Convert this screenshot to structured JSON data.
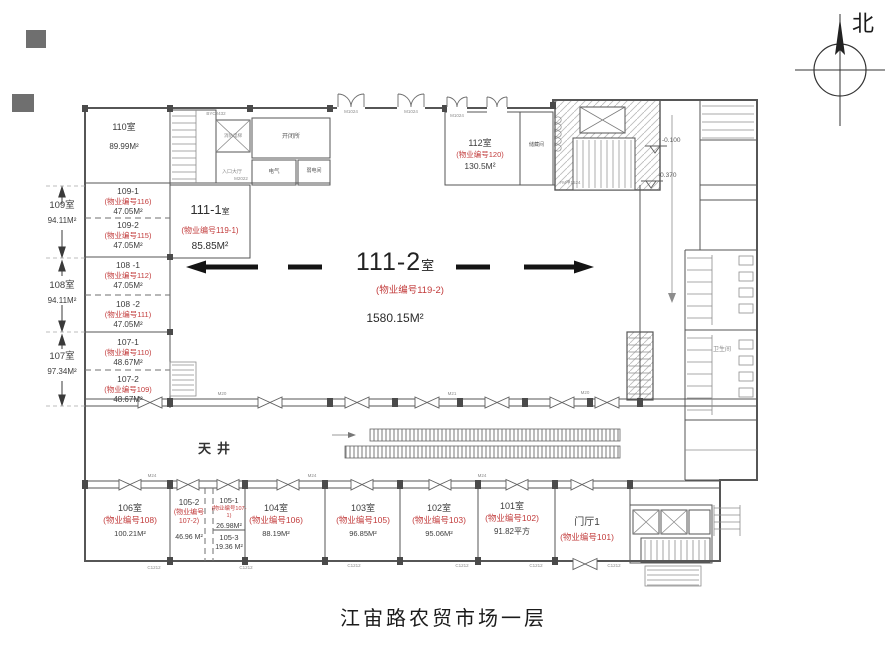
{
  "title": {
    "caption": "江宙路农贸市场一层"
  },
  "compass": {
    "north_label": "北"
  },
  "hall": {
    "num": "111-2",
    "suffix": "室",
    "code": "(物业编号119-2)",
    "area": "1580.15M²"
  },
  "rooms": {
    "r110": {
      "name": "110室",
      "area": "89.99M²"
    },
    "r111_1": {
      "num": "111-1",
      "suffix": "室",
      "code": "(物业编号119-1)",
      "area": "85.85M²"
    },
    "r112": {
      "name": "112室",
      "code": "(物业编号120)",
      "area": "130.5M²"
    },
    "r109_1": {
      "name": "109-1",
      "code": "(物业编号116)",
      "area": "47.05M²"
    },
    "r109_2": {
      "name": "109-2",
      "code": "(物业编号115)",
      "area": "47.05M²"
    },
    "r108_1": {
      "name": "108 -1",
      "code": "(物业编号112)",
      "area": "47.05M²"
    },
    "r108_2": {
      "name": "108 -2",
      "code": "(物业编号111)",
      "area": "47.05M²"
    },
    "r107_1": {
      "name": "107-1",
      "code": "(物业编号110)",
      "area": "48.67M²"
    },
    "r107_2": {
      "name": "107-2",
      "code": "(物业编号109)",
      "area": "48.67M²"
    },
    "r106": {
      "name": "106室",
      "code": "(物业编号108)",
      "area": "100.21M²"
    },
    "r105_2": {
      "name": "105-2",
      "code": "(物业编号107-2)",
      "area": "46.96 M²"
    },
    "r105_1": {
      "name": "105-1",
      "code": "(物业编号107-1)",
      "area": "26.98M²"
    },
    "r105_3": {
      "name": "105-3",
      "area": "19.36 M²"
    },
    "r104": {
      "name": "104室",
      "code": "(物业编号106)",
      "area": "88.19M²"
    },
    "r103": {
      "name": "103室",
      "code": "(物业编号105)",
      "area": "96.85M²"
    },
    "r102": {
      "name": "102室",
      "code": "(物业编号103)",
      "area": "95.06M²"
    },
    "r101": {
      "name": "101室",
      "code": "(物业编号102)",
      "area": "91.82平方"
    },
    "lobby": {
      "name": "门厅1",
      "code": "(物业编号101)"
    }
  },
  "dims": {
    "d109": {
      "name": "109室",
      "area": "94.11M²"
    },
    "d108": {
      "name": "108室",
      "area": "94.11M²"
    },
    "d107": {
      "name": "107室",
      "area": "97.34M²"
    }
  },
  "annotations": {
    "courtyard": "天井",
    "level_1": "-0.100",
    "level_2": "-0.370",
    "utility_big": "开闭所",
    "utility_elec": "电气",
    "utility_weak": "弱电间",
    "storage": "储藏间",
    "fire_elevator": "消防电梯",
    "entry_hall": "入口大厅",
    "wc": "卫生间",
    "door_byc": "BYC2432",
    "door_m2022": "M2022",
    "door_m1024": "M1024",
    "door_fm": "FM甲1524",
    "door_m20": "M20",
    "door_m21": "M21",
    "door_m24": "M24",
    "win_c1212": "C1212"
  },
  "colors": {
    "label_red": "#c23b3b",
    "line_dark": "#565656",
    "line_light": "#9a9a9a"
  }
}
